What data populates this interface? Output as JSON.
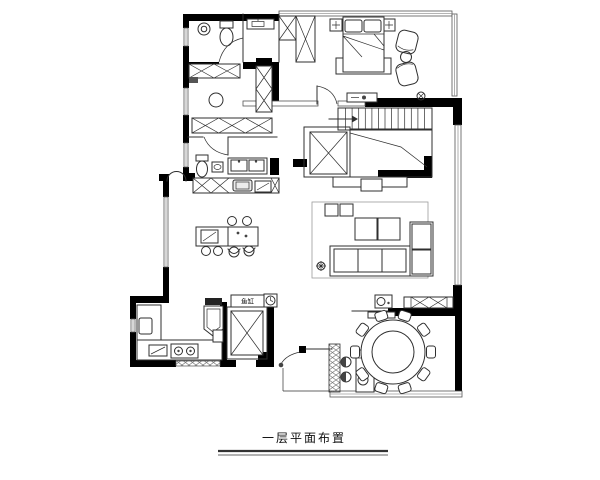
{
  "title": {
    "text": "一层平面布置"
  },
  "labels": {
    "fish_tank": "鱼缸"
  },
  "symbols": {
    "stair_direction_icon": "arrow-right",
    "ceiling_light_icon": "circle-with-x",
    "floor_drain_icon": "circle-with-cross"
  },
  "colors": {
    "wall": "#000000",
    "line": "#2f2f2f",
    "light_line": "#9b9b9b",
    "background": "#ffffff"
  }
}
